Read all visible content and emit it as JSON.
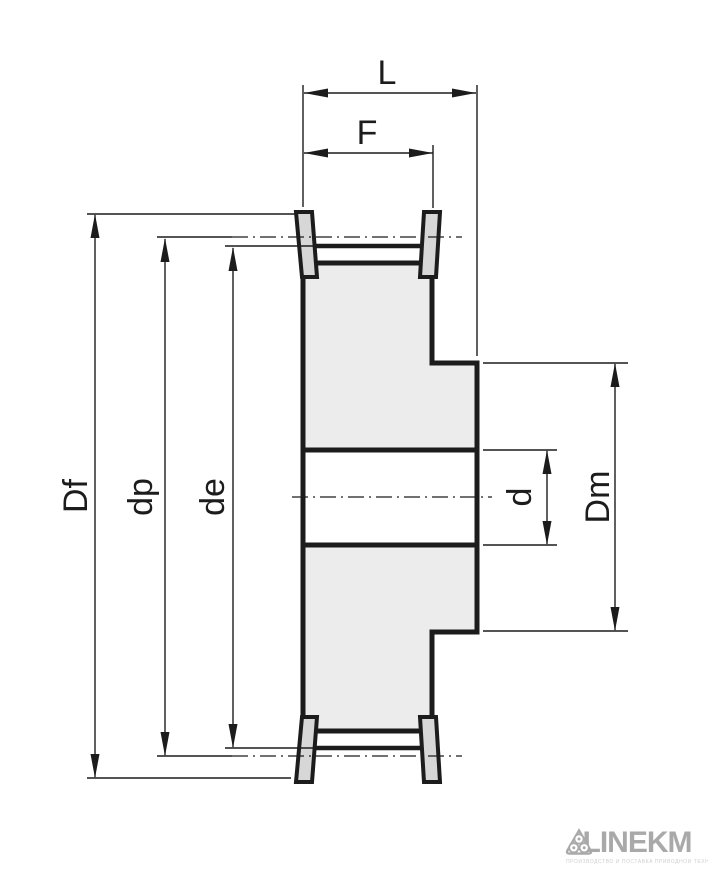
{
  "drawing": {
    "type": "timing-belt-pulley-cross-section",
    "dimensions": {
      "length": "L",
      "face_width": "F",
      "flange_diameter": "Df",
      "pitch_diameter": "dp",
      "outside_diameter": "de",
      "bore_diameter": "d",
      "hub_diameter": "Dm"
    }
  },
  "colors": {
    "line": "#1c1c1c",
    "body_fill": "#ececec",
    "flange_fill": "#d7d7d7",
    "logo": "#a9a9a9",
    "tagline": "#cfcfcf",
    "background": "#ffffff"
  },
  "logo": {
    "brand_left": "LINEK",
    "brand_right": "M",
    "icon": "three-rollers-icon",
    "tagline": "ПРОИЗВОДСТВО И ПОСТАВКА ПРИВОДНОЙ ТЕХНИКИ"
  }
}
